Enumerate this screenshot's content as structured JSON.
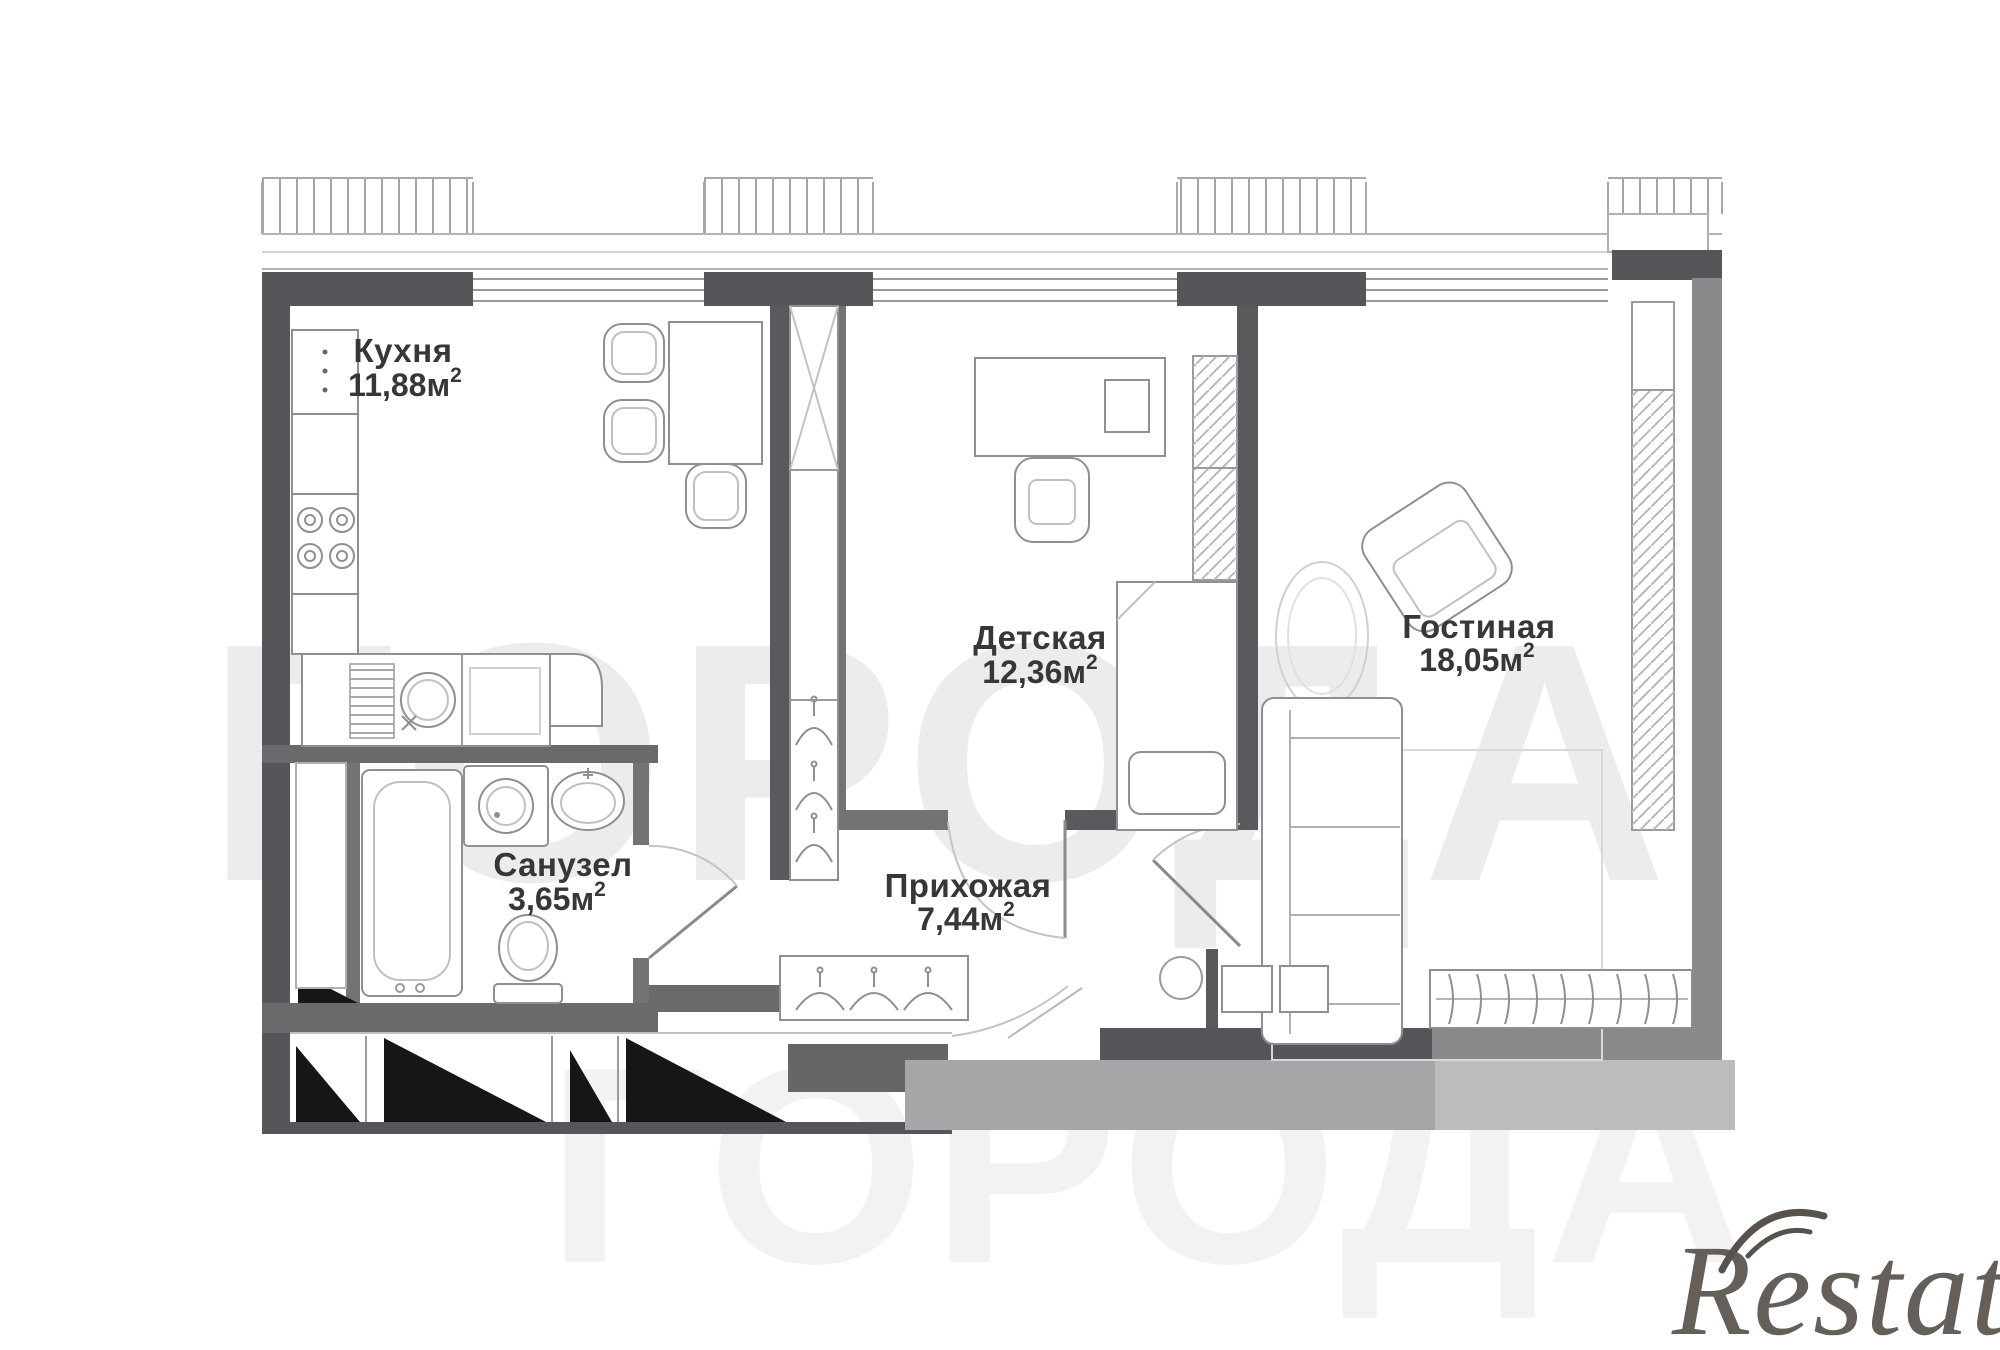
{
  "plan": {
    "rooms": [
      {
        "id": "kitchen",
        "name": "Кухня",
        "area": "11,88м",
        "sup": "2"
      },
      {
        "id": "nursery",
        "name": "Детская",
        "area": "12,36м",
        "sup": "2"
      },
      {
        "id": "living",
        "name": "Гостиная",
        "area": "18,05м",
        "sup": "2"
      },
      {
        "id": "bathroom",
        "name": "Санузел",
        "area": "3,65м",
        "sup": "2"
      },
      {
        "id": "hallway",
        "name": "Прихожая",
        "area": "7,44м",
        "sup": "2"
      }
    ],
    "colors": {
      "exterior_wall": "#56565a",
      "secondary_wall": "#8a8a8d",
      "interior_wall": "#6a6a6d",
      "slab_shadow": "#a6a6a8",
      "stairs": "#161616",
      "furniture_line": "#8f8f8f",
      "label": "#373737",
      "watermark": "#ececec",
      "logo": "#57524c"
    }
  },
  "watermark": {
    "text": "ГОРОДА"
  },
  "logo": {
    "text": "Restate"
  }
}
